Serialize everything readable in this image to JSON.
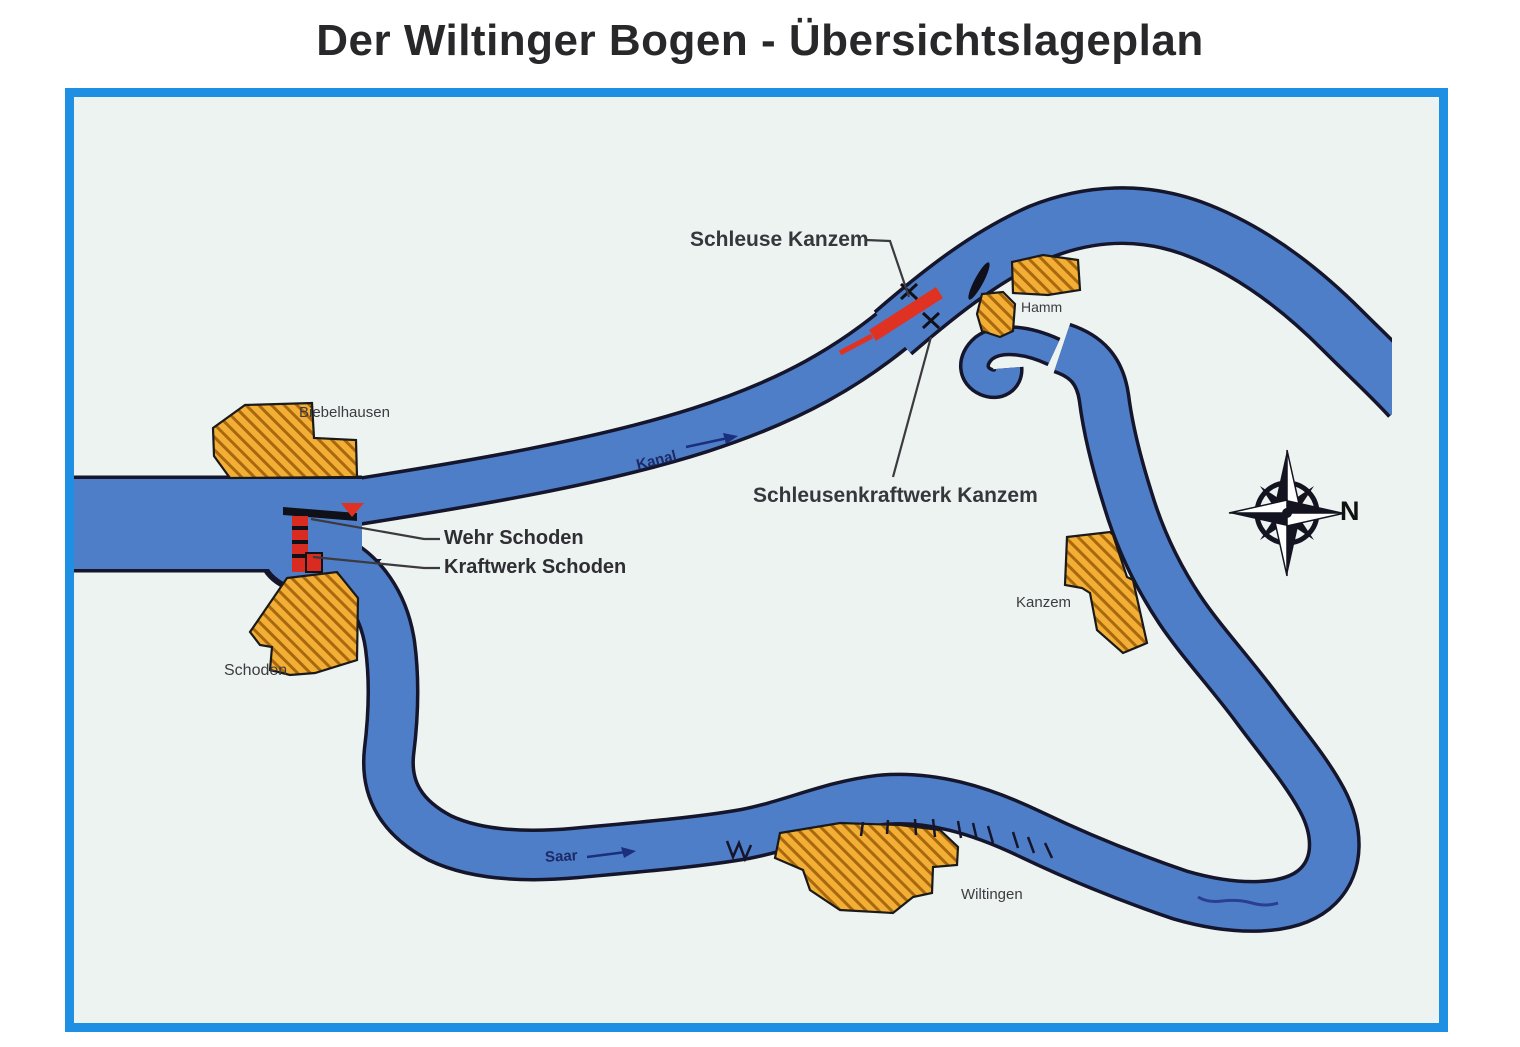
{
  "title": "Der Wiltinger Bogen - Übersichtslageplan",
  "map": {
    "waterways": {
      "kanal_label": "Kanal",
      "saar_label": "Saar"
    },
    "structures": {
      "schleuse_label": "Schleuse Kanzem",
      "schleusenkraftwerk_label": "Schleusenkraftwerk Kanzem",
      "wehr_label": "Wehr Schoden",
      "kraftwerk_label": "Kraftwerk Schoden"
    },
    "towns": [
      {
        "name": "Biebelhausen"
      },
      {
        "name": "Hamm"
      },
      {
        "name": "Kanzem"
      },
      {
        "name": "Schoden"
      },
      {
        "name": "Wiltingen"
      }
    ],
    "compass": {
      "north_label": "N"
    },
    "colors": {
      "river": "#4f7ec9",
      "outline": "#15152b",
      "frame": "#1e8fe3",
      "map_background": "#edf3f1",
      "town_fill": "#f3ae35",
      "town_hatch": "#a8690e",
      "structure_red": "#e03222"
    }
  }
}
